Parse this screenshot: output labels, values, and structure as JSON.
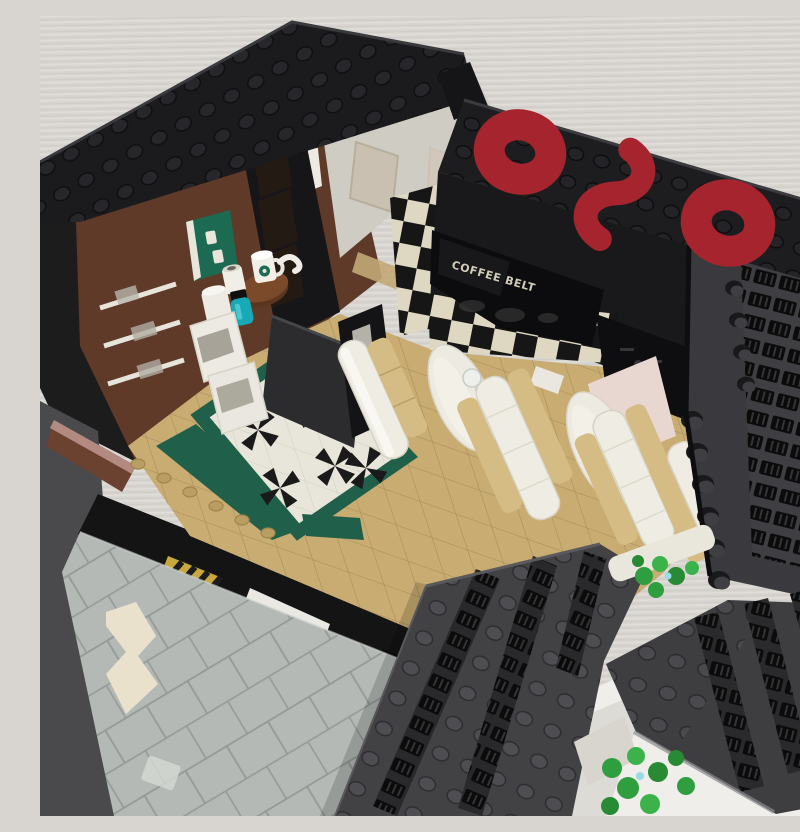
{
  "scene": {
    "type": "photograph",
    "subject": "LEGO modular brick-built coffee shop diner with open interior, viewed from above at a three-quarter angle",
    "environment": "model standing on a white desk against a light textured wall"
  },
  "signage": {
    "logo_text": "020",
    "logo_style": "red brick-built rings and S-curve on a black studded roof sign board",
    "logo_color": "#a5242d",
    "coffee_sign_text": "COFFEE BELT",
    "coffee_sign_graphic": "faint world map on glossy black panel",
    "coffee_sign_text_color": "#d2ccba"
  },
  "interior": {
    "floor": "tan square tile floor",
    "accent_floor": "white tiles with black pinwheel crosses framed by dark green tiles",
    "booths": "three white diner booths with tan seat cushions and two white oval tables, one clear glass on first table",
    "left_wall": "reddish-brown wall with white shelves and a green menu poster",
    "counter_items": [
      "white mug with green logo",
      "white jar",
      "white canister",
      "teal bottle with black cap",
      "two white coffee machines",
      "black storage shelf",
      "round brown side table"
    ],
    "feature_wall": "black and cream checkerboard tiles",
    "menu_boards": "glossy black menu panels with faint icons",
    "extras": [
      "white door frame",
      "translucent window panes",
      "pink wall panel",
      "black partition"
    ]
  },
  "exterior": {
    "walls": "black and dark bluish-gray brick walls textured with studs and grille tiles",
    "lower_level": "light gray brick pavement with cream zigzag accent, black fascia band with blank white sign tile and yellow-black hazard sticker",
    "plants": "two clusters of bright green leaf elements"
  },
  "palette": {
    "backdrop": "#d8d5d1",
    "desk": "#efeeea",
    "black_brick": "#1b1b1d",
    "dark_gray_brick": "#434346",
    "red_logo": "#a5242d",
    "brown_wall": "#5f3a28",
    "tan_floor": "#c9ac72",
    "green_tile": "#20604a",
    "white_tile": "#e8e5da",
    "checker_cream": "#ded8c2",
    "pavement": "#b4b9b6",
    "cushion_tan": "#d5bc84",
    "teal_bottle": "#17a9b5",
    "plant_green": "#2f9e3f",
    "pink_panel": "#e7d7d0"
  }
}
